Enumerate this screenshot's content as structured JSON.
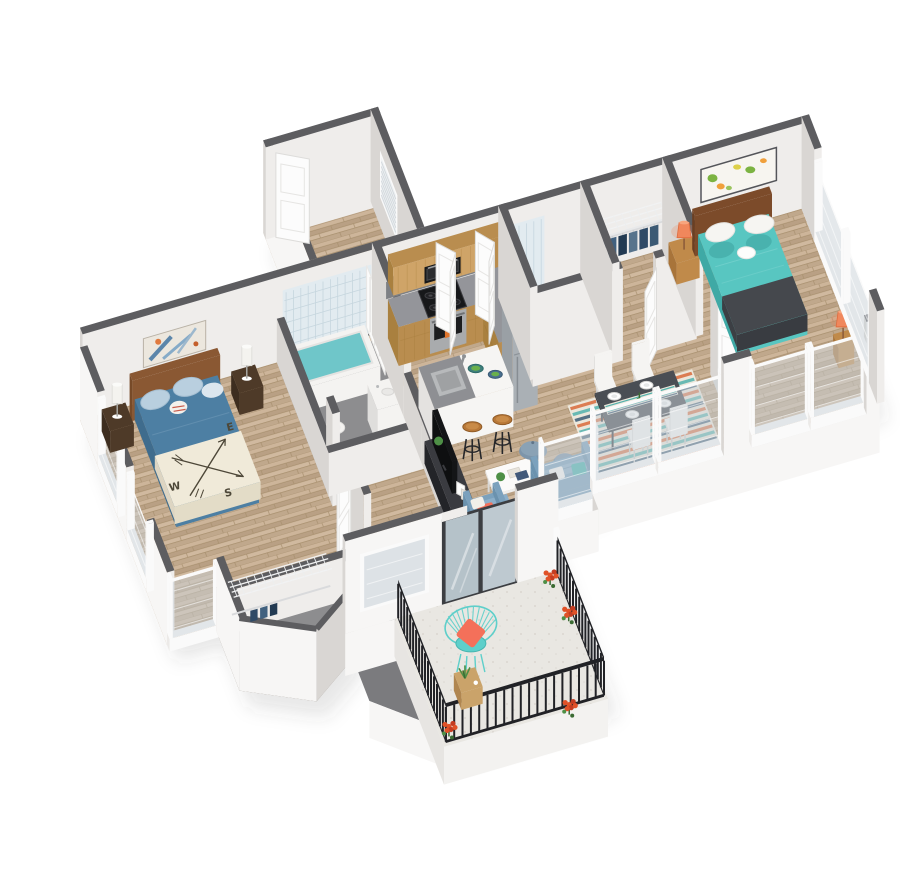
{
  "meta": {
    "description": "3D isometric floor plan rendering of a two-bedroom apartment with entry, kitchen, open living-dining area, two bathrooms, walk-in closets and a furnished balcony",
    "image_type": "architectural 3D floor plan render"
  },
  "master_bedroom": {
    "compass_blanket_letters": {
      "west": "W",
      "south": "S",
      "east": "E"
    }
  },
  "rooms": [
    "entry",
    "hallway",
    "kitchen",
    "living-room",
    "dining-area",
    "master-bedroom",
    "master-bathroom",
    "master-closet",
    "second-bathroom",
    "walk-in-closet",
    "second-bedroom",
    "balcony"
  ],
  "furniture": {
    "entry": [
      "front-door",
      "window-with-blinds",
      "bifold-closet-doors"
    ],
    "kitchen": [
      "upper-cabinets",
      "microwave",
      "range-with-oven",
      "refrigerator",
      "island-with-sink",
      "two-bar-stools",
      "serving-bowls"
    ],
    "living_room": [
      "media-console",
      "flat-screen-tv",
      "coffee-table",
      "armchair",
      "sofa",
      "two-poufs",
      "house-plants"
    ],
    "dining_area": [
      "dining-table",
      "table-runner",
      "four-place-settings",
      "four-white-chairs",
      "striped-rug"
    ],
    "master_bedroom": [
      "queen-bed",
      "compass-rose-blanket",
      "abstract-wall-art",
      "two-nightstands",
      "two-white-lamps",
      "wire-closet-shelving"
    ],
    "master_bathroom": [
      "bathtub",
      "shower-curtain",
      "curtain-rod",
      "toilet",
      "vanity",
      "tiled-wall"
    ],
    "second_bedroom": [
      "queen-bed",
      "world-map-art",
      "nightstand",
      "two-orange-lamps",
      "charcoal-throw"
    ],
    "second_bathroom": [
      "walk-in-shower",
      "toilet",
      "vanity"
    ],
    "walk_in_closet": [
      "wire-shelf",
      "hanging-clothes"
    ],
    "balcony": [
      "black-metal-railing",
      "teal-wire-chair",
      "coral-pillow",
      "wood-cube-table",
      "potted-flowers",
      "sliding-glass-door"
    ]
  },
  "colors": {
    "wall_cap": "#5d5d60",
    "wall_light": "#efedeb",
    "wall_mid": "#d9d6d3",
    "wall_outer": "#f7f6f5",
    "floor_gray": "#8d8d8f",
    "floor_gray_light": "#d6d6d7",
    "wedge_gray": "#7b7b7e",
    "rail_black": "#212226",
    "frame_white": "#fafafa",
    "mesh": "#c9d2d8",
    "door_white": "#fcfcfc",
    "door_shadow": "#dddcda",
    "glass_frame": "#3c3e42",
    "glass_blue": "#bcc9d1",
    "tile_blue": "#e2ebf0",
    "tile_line": "#c6d6de",
    "water_teal": "#6fc6c9",
    "curtain_white": "#fbfbfa",
    "rod_black": "#2a2b2d",
    "porcelain": "#f4f3f1",
    "porcelain_shadow": "#dfdedc",
    "steel": "#b7b9bb",
    "steel_dark": "#8e9194",
    "backsplash": "#7e8084",
    "cab_wood": "#cfa468",
    "cab_wood_dark": "#b98d4f",
    "cab_wood_deep": "#a9803f",
    "counter_gray": "#94959a",
    "stove_black": "#17181a",
    "oven_steel": "#a9abad",
    "towel_orange": "#e0762e",
    "fridge_gray": "#aab0b5",
    "fridge_dark": "#969da3",
    "island_white": "#f6f5f3",
    "island_shadow": "#e4e2e0",
    "bar_gray": "#8e8f93",
    "stool_wood": "#b87838",
    "metal_black": "#26272a",
    "bowl_teal": "#3f7f7c",
    "bowl_green": "#6ab04c",
    "tv_black": "#141517",
    "console_dark": "#2c2d31",
    "console_top": "#3a3b40",
    "sofa_blue": "#7ba1bd",
    "sofa_light": "#8cafc9",
    "sofa_dark": "#6b92ae",
    "pouf_blue": "#7d95aa",
    "pouf_blue2": "#70889d",
    "table_dark": "#4a4e54",
    "table_side": "#3e4248",
    "chair_white": "#f5f4f2",
    "chair_shadow": "#e2e1df",
    "rug_cream": "#ece7db",
    "rug_orange": "#d96a3b",
    "rug_teal": "#52b0ac",
    "rug_navy": "#3c5a74",
    "bed_blue": "#4d7fa3",
    "bed_blue_dark": "#3f6c8d",
    "blanket_cream": "#f0ead9",
    "blanket_side": "#e3dcc7",
    "compass_ink": "#4d4738",
    "pillow_blue": "#b9cfdf",
    "headboard_wood": "#8a5833",
    "nightstand_dark": "#4e3a28",
    "lamp_white": "#f4f3ef",
    "bed2_teal": "#58c6c1",
    "bed2_dark": "#3fa9a5",
    "throw_char": "#45484d",
    "throw_side": "#393c41",
    "pillow_white": "#f6f5f2",
    "teal_pillow": "#49b2ae",
    "headboard2": "#7c4b2a",
    "wood_stand": "#c08a4a",
    "wood_stand_dark": "#a8743a",
    "lamp_orange": "#f0875c",
    "map_paper": "#f7f5f0",
    "map_green": "#7cb342",
    "map_orange": "#f0a03c",
    "map_yellow": "#ddd04a",
    "map_frame": "#54555a",
    "art_paper": "#ece7de",
    "art_blue": "#5c86aa",
    "art_blue2": "#86abc8",
    "art_orange": "#e07a3e",
    "chair_teal": "#5ecfca",
    "pillow_coral": "#f4705a",
    "cube_wood": "#caa36a",
    "plant_green": "#4e8f46",
    "flower_orange": "#e05228",
    "flower_red": "#c43d22",
    "clothes": [
      "#2f4a66",
      "#41617f",
      "#223a52",
      "#58748c",
      "#2f4a66",
      "#3c5a74"
    ]
  }
}
